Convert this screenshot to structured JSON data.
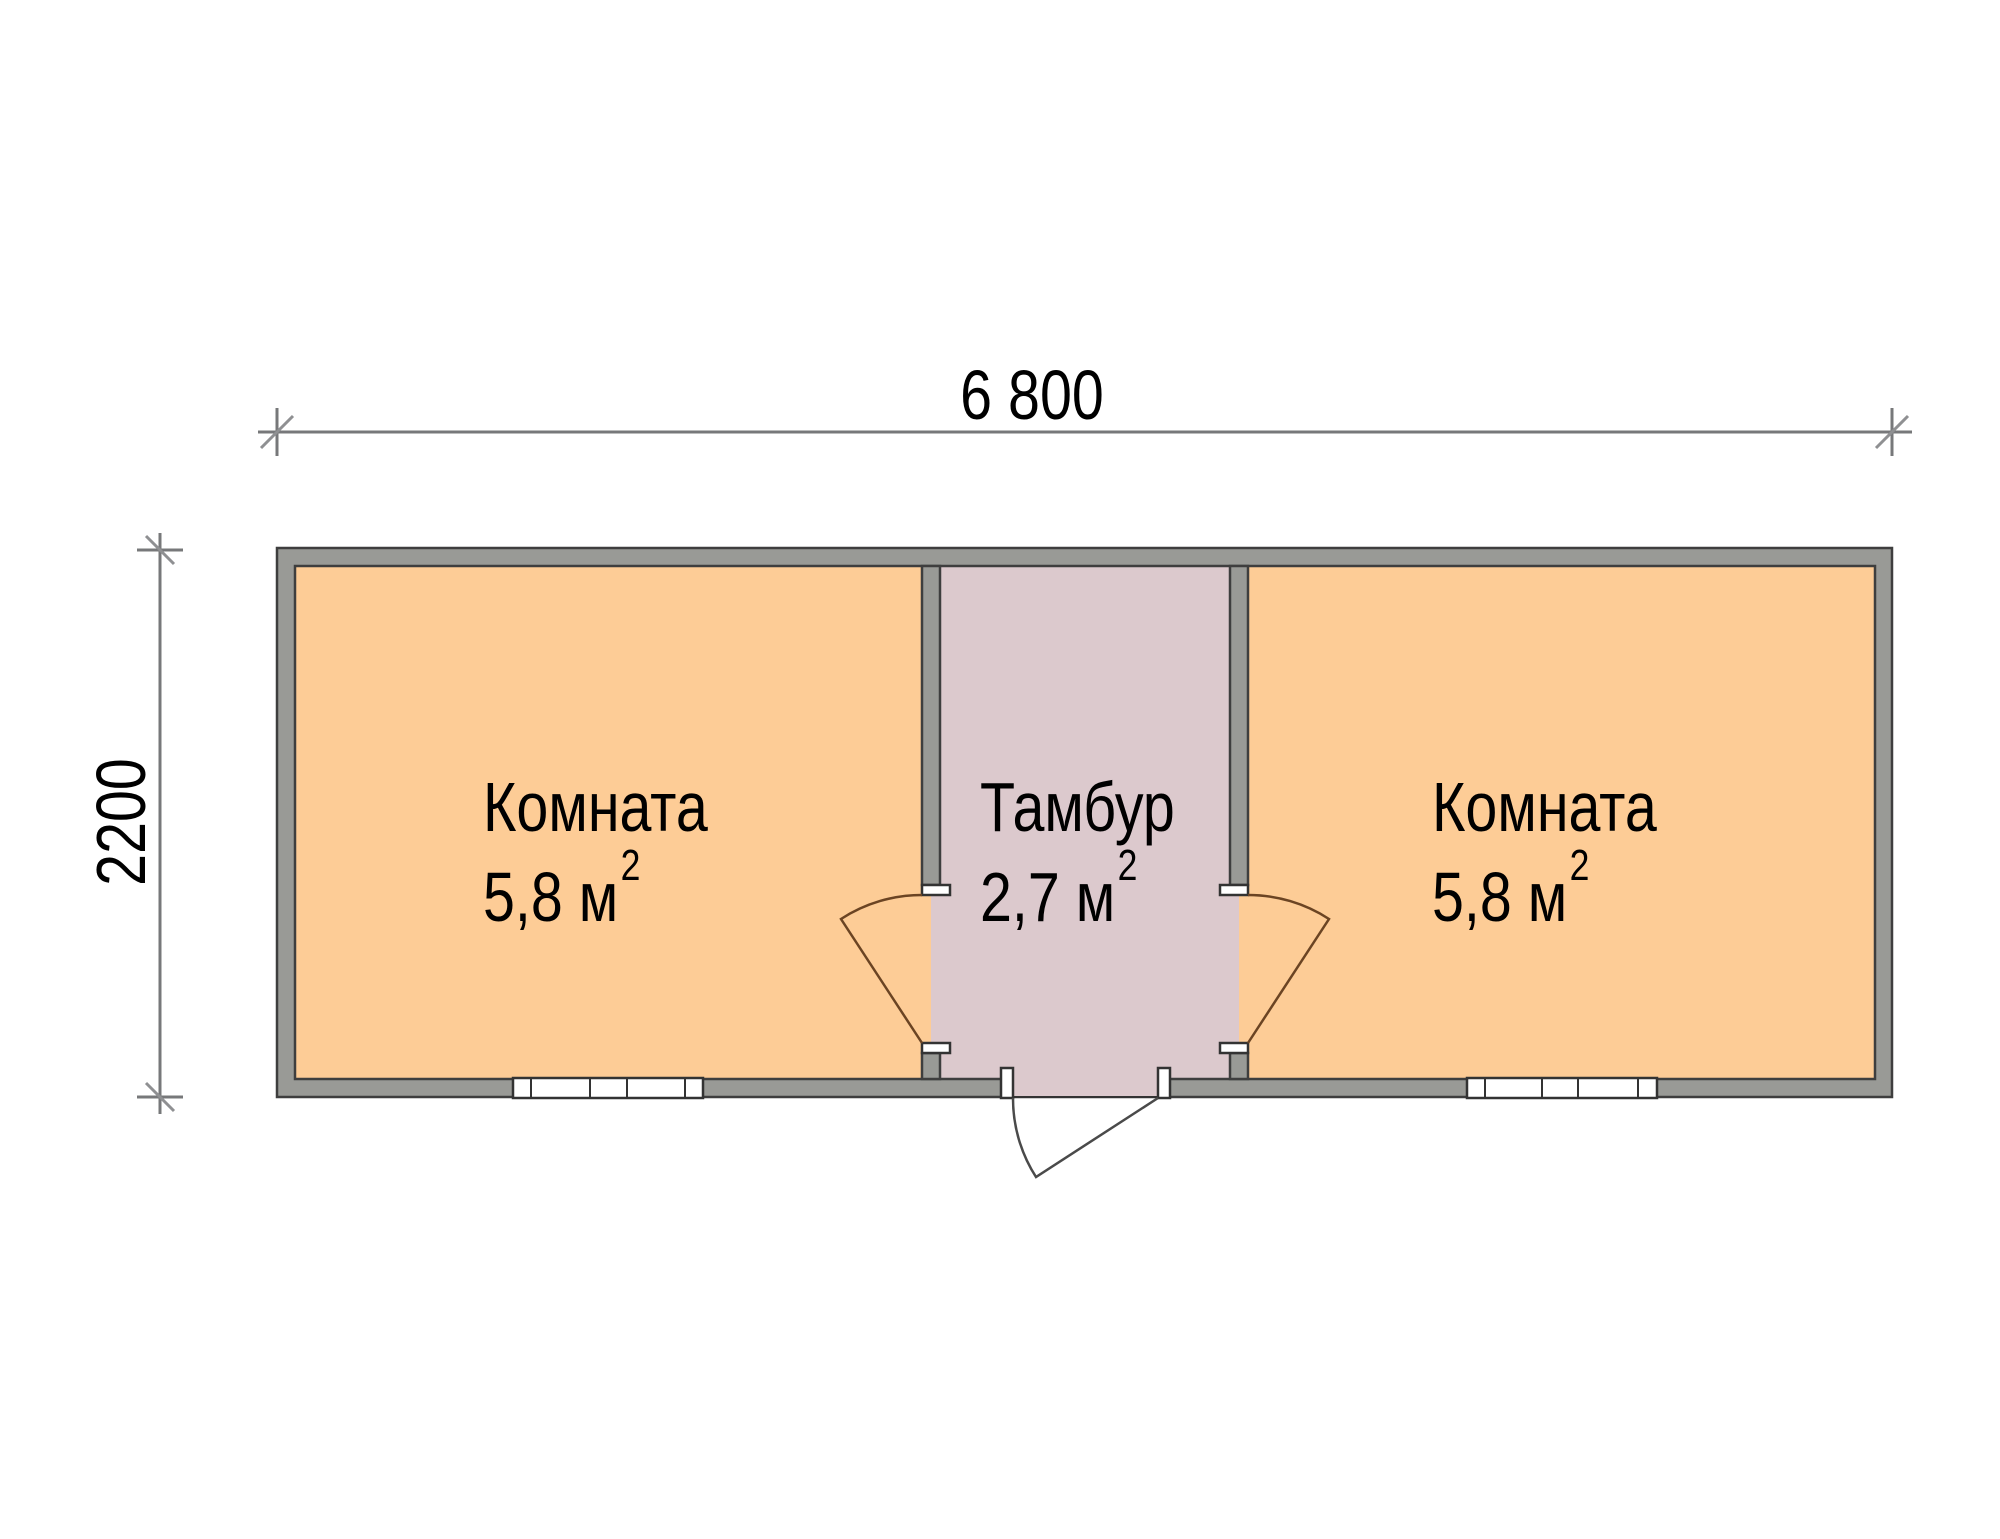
{
  "plan": {
    "width_dimension": "6 800",
    "height_dimension": "2200",
    "rooms": [
      {
        "id": "room-left",
        "name": "Комната",
        "area": "5,8 м",
        "area_superscript": "2"
      },
      {
        "id": "vestibule",
        "name": "Тамбур",
        "area": "2,7 м",
        "area_superscript": "2"
      },
      {
        "id": "room-right",
        "name": "Комната",
        "area": "5,8 м",
        "area_superscript": "2"
      }
    ]
  },
  "colors": {
    "room_fill": "#FDCC96",
    "vestibule_fill": "#DCC9CD",
    "wall_fill": "#999A96",
    "dimension_line": "#77787a",
    "text": "#000000"
  }
}
